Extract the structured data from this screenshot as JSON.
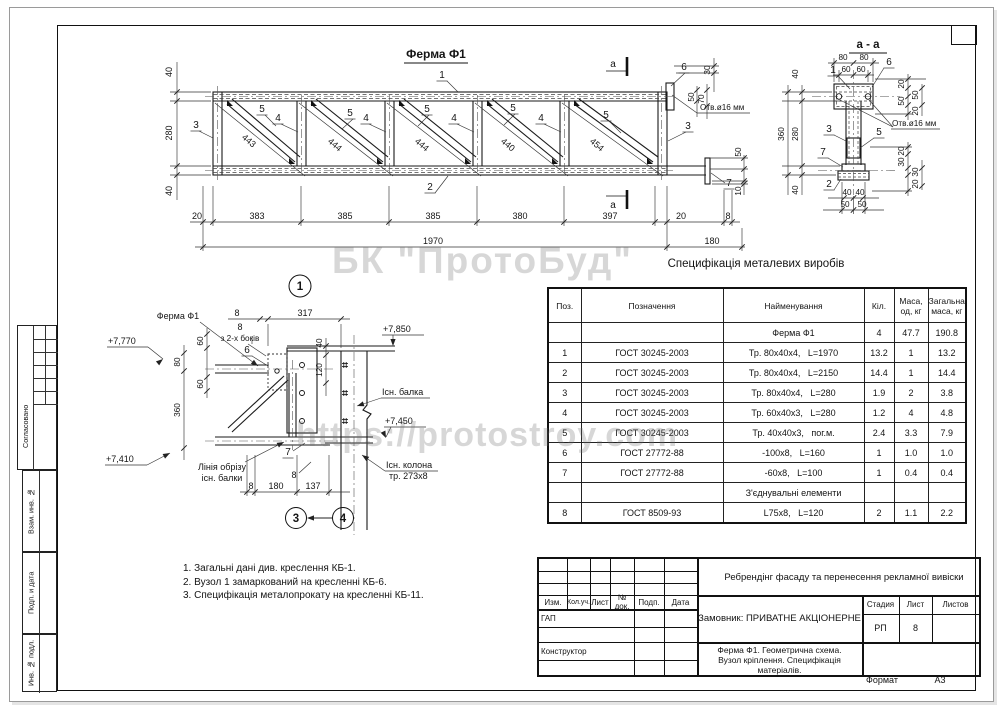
{
  "watermarks": {
    "company": "БК \"ПротоБуд\"",
    "site": "https://protostroy.com"
  },
  "truss": {
    "title": "Ферма Ф1",
    "section_letter": "а",
    "pos1": "1",
    "pos2": "2",
    "pos3": "3",
    "pos4": "4",
    "pos5": "5",
    "pos6": "6",
    "pos7": "7",
    "diag_dims": [
      "443",
      "444",
      "444",
      "440",
      "454"
    ],
    "left_dims": [
      "40",
      "280",
      "40"
    ],
    "bottom_dims": [
      "20",
      "383",
      "385",
      "385",
      "380",
      "397",
      "20",
      "8"
    ],
    "total_length": "1970",
    "right_ext": "180",
    "dim_30": "30",
    "dim_50": "50",
    "dim_70": "70",
    "dim_50b": "50",
    "dim_10": "10",
    "hole_note": "Отв.ø16 мм"
  },
  "section": {
    "title": "а - а",
    "dim_80": "80",
    "dim_60": "60",
    "dim_360": "360",
    "dim_280": "280",
    "dim_40": "40",
    "dim_20": "20",
    "dim_50": "50",
    "dim_30": "30",
    "bottom_40": "40",
    "bottom_50": "50",
    "hole_note": "Отв.ø16 мм",
    "pos1": "1",
    "pos2": "2",
    "pos3": "3",
    "pos5": "5",
    "pos6": "6",
    "pos7": "7"
  },
  "node": {
    "bubble_1": "1",
    "bubble_3": "3",
    "bubble_4": "4",
    "ferma_label": "Ферма Ф1",
    "weld_size": "8",
    "weld_note": "з 2-х боків",
    "pos6": "6",
    "pos7": "7",
    "weld_8": "8",
    "elev_top_left": "+7,770",
    "elev_beam": "+7,850",
    "elev_mid": "+7,450",
    "elev_bottom": "+7,410",
    "dim_8": "8",
    "dim_317": "317",
    "dim_40": "40",
    "dim_120": "120",
    "dim_60a": "60",
    "dim_80": "80",
    "dim_60b": "60",
    "dim_360": "360",
    "beam_label": "Існ. балка",
    "column_label_1": "Існ. колона",
    "column_label_2": "тр. 273х8",
    "cut_label_1": "Лінія обрізу",
    "cut_label_2": "існ. балки",
    "bdim_8": "8",
    "bdim_180": "180",
    "bdim_137": "137"
  },
  "notes": {
    "n1": "1. Загальні дані див. креслення КБ-1.",
    "n2": "2. Вузол 1 замаркований на кресленні КБ-6.",
    "n3": "3. Специфікація металопрокату на кресленні КБ-11."
  },
  "spec": {
    "title": "Специфікація металевих виробів",
    "h_pos": "Поз.",
    "h_desig": "Позначення",
    "h_name": "Найменування",
    "h_qty": "Кіл.",
    "h_mass": "Маса,\nод, кг",
    "h_total": "Загальна\nмаса, кг",
    "rows": [
      {
        "pos": "",
        "desig": "",
        "name": "Ферма Ф1",
        "qty": "4",
        "mass": "47.7",
        "total": "190.8"
      },
      {
        "pos": "1",
        "desig": "ГОСТ 30245-2003",
        "name": "Тр. 80х40х4,   L=1970",
        "qty": "13.2",
        "mass": "1",
        "total": "13.2"
      },
      {
        "pos": "2",
        "desig": "ГОСТ 30245-2003",
        "name": "Тр. 80х40х4,   L=2150",
        "qty": "14.4",
        "mass": "1",
        "total": "14.4"
      },
      {
        "pos": "3",
        "desig": "ГОСТ 30245-2003",
        "name": "Тр. 80х40х4,   L=280",
        "qty": "1.9",
        "mass": "2",
        "total": "3.8"
      },
      {
        "pos": "4",
        "desig": "ГОСТ 30245-2003",
        "name": "Тр. 60х40х3,   L=280",
        "qty": "1.2",
        "mass": "4",
        "total": "4.8"
      },
      {
        "pos": "5",
        "desig": "ГОСТ 30245-2003",
        "name": "Тр. 40х40х3,   пог.м.",
        "qty": "2.4",
        "mass": "3.3",
        "total": "7.9"
      },
      {
        "pos": "6",
        "desig": "ГОСТ 27772-88",
        "name": "-100х8,   L=160",
        "qty": "1",
        "mass": "1.0",
        "total": "1.0"
      },
      {
        "pos": "7",
        "desig": "ГОСТ 27772-88",
        "name": "-60х8,   L=100",
        "qty": "1",
        "mass": "0.4",
        "total": "0.4"
      },
      {
        "pos": "",
        "desig": "",
        "name": "З'єднувальні елементи",
        "qty": "",
        "mass": "",
        "total": ""
      },
      {
        "pos": "8",
        "desig": "ГОСТ 8509-93",
        "name": "L75х8,   L=120",
        "qty": "2",
        "mass": "1.1",
        "total": "2.2"
      }
    ]
  },
  "titleblock": {
    "project": "Ребрендінг фасаду та перенесення рекламної вивіски",
    "client": "Замовник: ПРИВАТНЕ АКЦІОНЕРНЕ",
    "doc_1": "Ферма Ф1. Геометрична схема.",
    "doc_2": "Вузол кріплення. Специфікація",
    "doc_3": "матеріалів.",
    "h_izm": "Изм.",
    "h_kol": "Кол.уч.",
    "h_list": "Лист",
    "h_doc": "№ док.",
    "h_podp": "Подп.",
    "h_data": "Дата",
    "role_gap": "ГАП",
    "role_constr": "Конструктор",
    "h_stage": "Стадия",
    "h_sheet": "Лист",
    "h_sheets": "Листов",
    "stage": "РП",
    "sheet": "8",
    "format_label": "Формат",
    "format_value": "А3"
  },
  "margin": {
    "agreed": "Согласовано",
    "vzam": "Взам. инв. №",
    "podp": "Подп. и дата",
    "inv": "Инв. № подл."
  }
}
